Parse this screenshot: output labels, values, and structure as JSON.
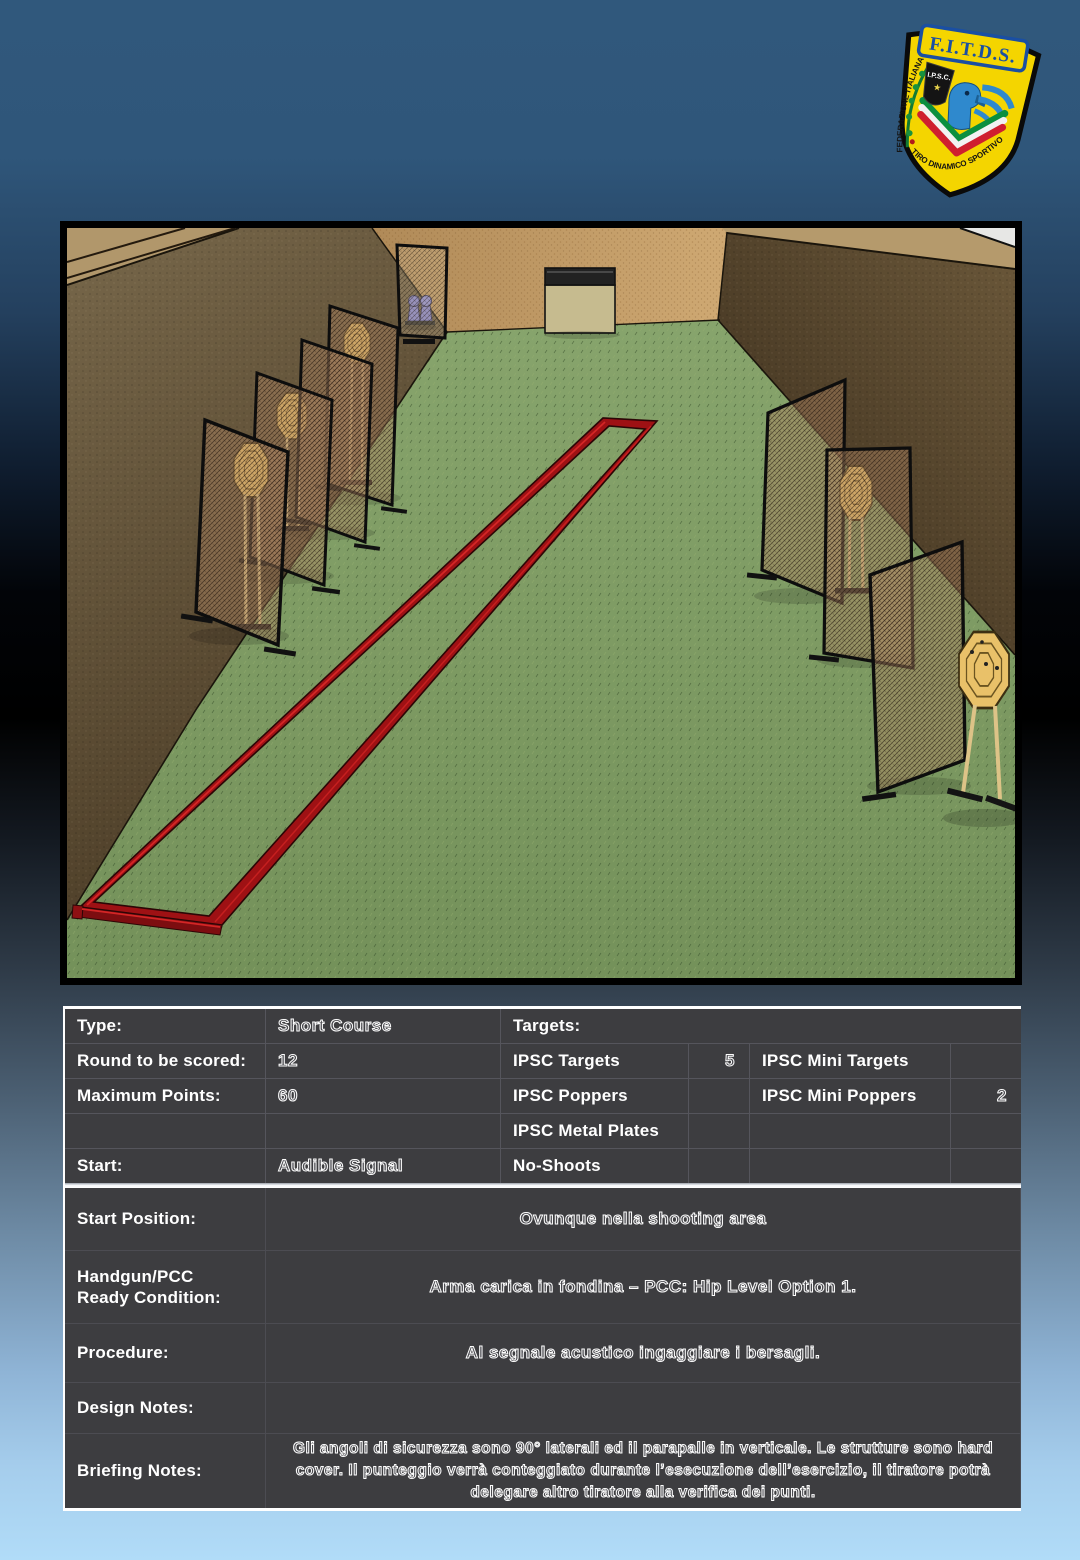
{
  "logo": {
    "acronym": "F.I.T.D.S.",
    "arc_left": "FEDERAZIONE ITALIANA",
    "arc_bottom": "TIRO DINAMICO SPORTIVO",
    "ipsc": "I.P.S.C.",
    "colors": {
      "shield": "#f4d500",
      "band_blue": "#1a4fa3",
      "eagle_blue": "#2f89cd",
      "green": "#0c8f3f",
      "red": "#cf1f2f"
    }
  },
  "stage_diagram": {
    "description": "3D render of shooting bay: brown side berms, tan back berm, green floor, red shooting-area frame, chain-link mesh walls hiding IPSC cardboard targets, two mini poppers behind rear mesh, plywood box at back",
    "colors": {
      "floor": "#7d9a63",
      "back_berm": "#c7a06a",
      "left_berm": "#6b5b40",
      "right_berm": "#5c4a31",
      "frame_red": "#9e1114",
      "target_tan": "#e9c169",
      "popper_blue": "#7d7dc8"
    }
  },
  "info": {
    "type_label": "Type:",
    "type_value": "Short Course",
    "rounds_label": "Round to be scored:",
    "rounds_value": "12",
    "max_points_label": "Maximum Points:",
    "max_points_value": "60",
    "start_label": "Start:",
    "start_value": "Audible Signal",
    "targets_label": "Targets:",
    "ipsc_targets_label": "IPSC Targets",
    "ipsc_targets_value": "5",
    "ipsc_mini_targets_label": "IPSC Mini Targets",
    "ipsc_mini_targets_value": "",
    "ipsc_poppers_label": "IPSC Poppers",
    "ipsc_poppers_value": "",
    "ipsc_mini_poppers_label": "IPSC Mini Poppers",
    "ipsc_mini_poppers_value": "2",
    "ipsc_metal_plates_label": "IPSC Metal Plates",
    "no_shoots_label": "No-Shoots"
  },
  "briefing": {
    "start_position_label": "Start Position:",
    "start_position_value": "Ovunque nella shooting area",
    "ready_condition_label_line1": "Handgun/PCC",
    "ready_condition_label_line2": "Ready Condition:",
    "ready_condition_value": "Arma carica in fondina – PCC: Hip Level Option 1.",
    "procedure_label": "Procedure:",
    "procedure_value": "Al segnale acustico ingaggiare i bersagli.",
    "design_notes_label": "Design Notes:",
    "design_notes_value": "",
    "briefing_notes_label": "Briefing Notes:",
    "briefing_notes_value": "Gli angoli di sicurezza sono 90° laterali ed il parapalle in verticale. Le strutture sono hard cover. Il punteggio verrà conteggiato durante l’esecuzione dell’esercizio, il tiratore potrà delegare altro tiratore alla verifica dei punti."
  }
}
